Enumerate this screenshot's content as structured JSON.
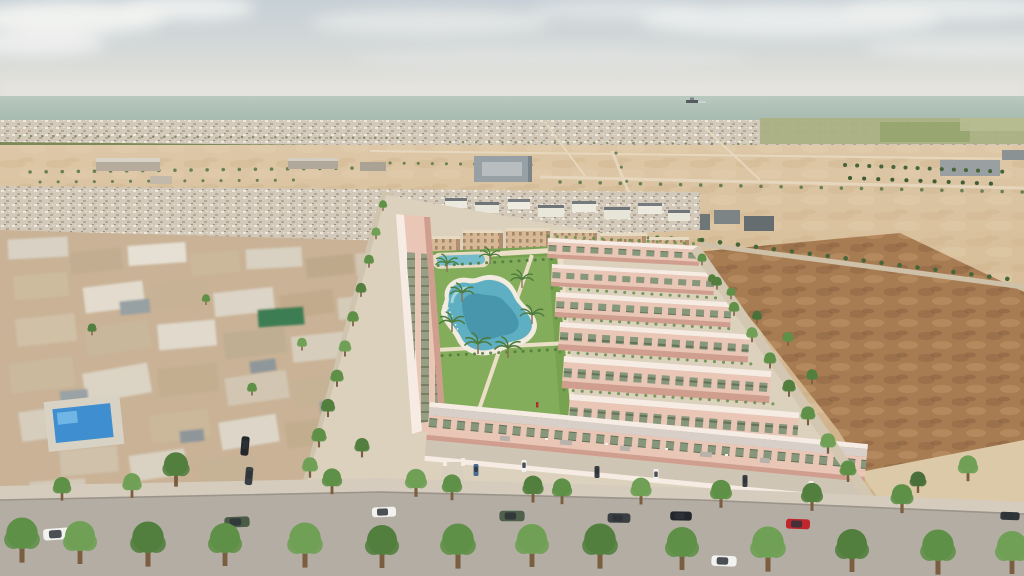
{
  "scene": {
    "type": "3d-architectural-aerial-render",
    "description": "Bird's-eye 3D rendering of a new-build residential complex of pink two-storey townhouses arranged in rows around a central landscaped park with a lagoon-style communal pool and palm trees. An older low-rise town sits to the left (with a private blue pool), empty desert scrub plots lie to the right, and sandy lots, farmland and a dense coastal town stretch back to the sea on the horizon under a pale hazy sky with soft clouds.",
    "regions": [
      "sky with soft clouds",
      "sea horizon with distant ship",
      "distant coastal town strip",
      "green farmland and orchards",
      "sandy undeveloped plots with grid roads and palm rows",
      "old low-rise town (left) with private pool",
      "new development of pink townhouses",
      "central park with lagoon pool and palms",
      "brown desert scrub plot (right)",
      "tree-lined asphalt road with parked cars (foreground)"
    ],
    "objects": {
      "ship": "small cargo ship on the sea horizon",
      "old_town_pool": "bright blue rectangular private pool, bottom-left",
      "lagoon_pool": "irregular turquoise communal lagoon pool in central park",
      "small_pools": "secondary leisure pools at the top of the park",
      "pedestrian": "person in red on interior street",
      "street_trees": "rows of round green street trees lining the roads",
      "palm_trees": "palm trees in the park and along distant avenues"
    },
    "vehicles": [
      {
        "color": "white",
        "location": "road, far left"
      },
      {
        "color": "dark green",
        "location": "road, left of entrance"
      },
      {
        "color": "white",
        "location": "road, left-centre"
      },
      {
        "color": "olive green",
        "location": "road, centre"
      },
      {
        "color": "dark grey",
        "location": "road, right-centre"
      },
      {
        "color": "black",
        "location": "road, right-centre"
      },
      {
        "color": "red",
        "location": "road, right"
      },
      {
        "color": "white",
        "location": "road, lower lane (moving)"
      },
      {
        "color": "dark grey",
        "location": "road, far right edge"
      },
      {
        "color": "black x2",
        "location": "side street, parked vertically"
      },
      {
        "color": "assorted",
        "location": "townhouse driveways"
      }
    ]
  },
  "colors": {
    "sky_top": "#c6d0d6",
    "sky_horizon": "#e8e5dd",
    "cloud": "#f2f3f1",
    "sea": "#a6bab1",
    "sea_light": "#b9c8bf",
    "distant_town": "#d3c9ba",
    "field_green": "#aab183",
    "orchard": "#7c8a57",
    "sand": "#d8c09e",
    "sand_dark": "#c3a378",
    "scrub": "#a87c52",
    "scrub_dark": "#8d6743",
    "concrete": "#dcd1bc",
    "road": "#b4ada4",
    "sidewalk": "#d5ccbe",
    "old_town": "#c9b296",
    "old_town_light": "#e4ddd1",
    "old_town_gray": "#98a0a2",
    "pool_blue": "#3e8ed0",
    "tarp_green": "#3e7d52",
    "apartment_tan": "#d6b896",
    "apartment_shadow": "#b18f6d",
    "villa_wall": "#e9c6b6",
    "villa_shadow": "#d09e8e",
    "villa_trim": "#f6ece4",
    "window_green": "#87977b",
    "park_green": "#77a250",
    "park_green_light": "#93b969",
    "path": "#ecdfc7",
    "lagoon": "#5fafc2",
    "lagoon_deep": "#3d8ba3",
    "lagoon_light": "#a8d8de",
    "tree_green": "#5f9047",
    "tree_dark": "#49703a",
    "palm_green": "#4e7c3e",
    "trunk": "#7b5d40",
    "car_white": "#f2f2f0",
    "car_dark": "#3a3f44",
    "car_black": "#23272b",
    "car_red": "#c0272d",
    "car_green": "#4a5c46",
    "car_olive": "#50614b",
    "car_blue": "#4a6c8e",
    "ship": "#565b60"
  }
}
